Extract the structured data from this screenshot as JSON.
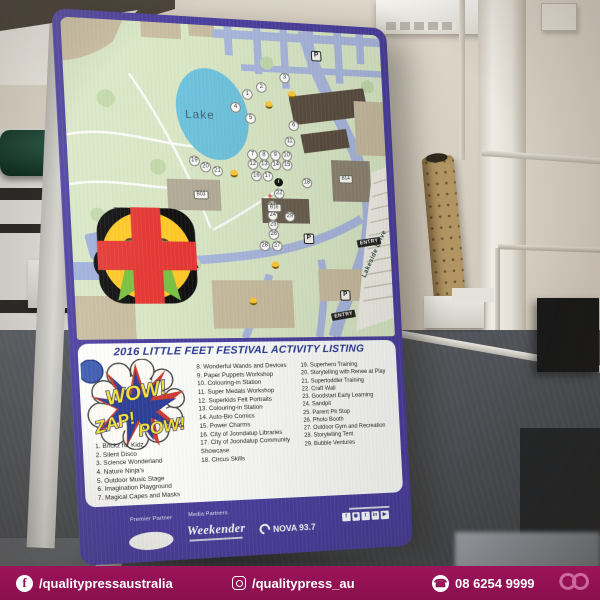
{
  "footer": {
    "facebook_handle": "/qualitypressaustralia",
    "instagram_handle": "/qualitypress_au",
    "phone": "08 6254 9999",
    "bar_color": "#931253"
  },
  "poster": {
    "accent_color": "#4b3f9d",
    "map": {
      "lake_label": "Lake",
      "road_label": "Lakeside Drive",
      "entry_label": "ENTRY",
      "parking_symbol": "P",
      "colors": {
        "ground": "#d9e7c6",
        "road": "#a9b7dd",
        "lake": "#6fc3dd",
        "building_tan": "#c9bda0",
        "building_dark": "#5a4e40"
      },
      "legend": [
        {
          "icon": "toilets-icon",
          "label": "Toilets"
        },
        {
          "icon": "acrod-toilets-icon",
          "label": "ACROD toilets"
        },
        {
          "icon": "event-info-icon",
          "label": "Event information"
        },
        {
          "icon": "parking-icon",
          "label": "Parking"
        },
        {
          "icon": "baby-changing-icon",
          "label": "Baby changing"
        },
        {
          "icon": "face-painter-icon",
          "label": "Face painter"
        },
        {
          "icon": "constable-care-icon",
          "label": "Constable Care (Lost Children)"
        },
        {
          "icon": "first-aid-icon",
          "label": "First Aid"
        }
      ],
      "overlays": [
        {
          "t": "num",
          "n": "1",
          "x": 183,
          "y": 70
        },
        {
          "t": "num",
          "n": "2",
          "x": 198,
          "y": 62
        },
        {
          "t": "num",
          "n": "3",
          "x": 223,
          "y": 51
        },
        {
          "t": "num",
          "n": "4",
          "x": 170,
          "y": 84
        },
        {
          "t": "num",
          "n": "5",
          "x": 185,
          "y": 95
        },
        {
          "t": "num",
          "n": "6",
          "x": 230,
          "y": 101
        },
        {
          "t": "num",
          "n": "7",
          "x": 185,
          "y": 133
        },
        {
          "t": "num",
          "n": "8",
          "x": 197,
          "y": 133
        },
        {
          "t": "num",
          "n": "9",
          "x": 209,
          "y": 133
        },
        {
          "t": "num",
          "n": "10",
          "x": 221,
          "y": 133
        },
        {
          "t": "num",
          "n": "11",
          "x": 225,
          "y": 118
        },
        {
          "t": "num",
          "n": "12",
          "x": 185,
          "y": 143
        },
        {
          "t": "num",
          "n": "13",
          "x": 197,
          "y": 143
        },
        {
          "t": "num",
          "n": "14",
          "x": 209,
          "y": 143
        },
        {
          "t": "num",
          "n": "15",
          "x": 221,
          "y": 143
        },
        {
          "t": "num",
          "n": "16",
          "x": 188,
          "y": 155
        },
        {
          "t": "num",
          "n": "17",
          "x": 200,
          "y": 155
        },
        {
          "t": "num",
          "n": "18",
          "x": 241,
          "y": 161
        },
        {
          "t": "num",
          "n": "19",
          "x": 125,
          "y": 141
        },
        {
          "t": "num",
          "n": "20",
          "x": 136,
          "y": 147
        },
        {
          "t": "num",
          "n": "21",
          "x": 148,
          "y": 151
        },
        {
          "t": "num",
          "n": "22",
          "x": 211,
          "y": 173
        },
        {
          "t": "num",
          "n": "23",
          "x": 203,
          "y": 186
        },
        {
          "t": "num",
          "n": "24",
          "x": 203,
          "y": 196
        },
        {
          "t": "num",
          "n": "25",
          "x": 203,
          "y": 206
        },
        {
          "t": "num",
          "n": "26",
          "x": 203,
          "y": 216
        },
        {
          "t": "num",
          "n": "27",
          "x": 206,
          "y": 228
        },
        {
          "t": "num",
          "n": "28",
          "x": 193,
          "y": 228
        },
        {
          "t": "num",
          "n": "29",
          "x": 221,
          "y": 197
        },
        {
          "t": "smiley",
          "x": 205,
          "y": 80
        },
        {
          "t": "smiley",
          "x": 230,
          "y": 68
        },
        {
          "t": "smiley",
          "x": 165,
          "y": 153
        },
        {
          "t": "smiley",
          "x": 203,
          "y": 248
        },
        {
          "t": "smiley",
          "x": 178,
          "y": 286
        },
        {
          "t": "toilets",
          "x": 160,
          "y": 167
        },
        {
          "t": "toilets",
          "x": 263,
          "y": 206
        },
        {
          "t": "toilets",
          "x": 175,
          "y": 266
        },
        {
          "t": "parking",
          "x": 258,
          "y": 26
        },
        {
          "t": "parking",
          "x": 240,
          "y": 220
        },
        {
          "t": "parking",
          "x": 276,
          "y": 280
        },
        {
          "t": "entry",
          "x": 305,
          "y": 223
        },
        {
          "t": "entry",
          "x": 273,
          "y": 301
        },
        {
          "t": "info",
          "x": 211,
          "y": 161
        },
        {
          "t": "firstaid",
          "x": 201,
          "y": 176
        },
        {
          "t": "bldg",
          "label": "B03",
          "x": 130,
          "y": 176
        },
        {
          "t": "bldg",
          "label": "B16",
          "x": 205,
          "y": 188
        },
        {
          "t": "bldg",
          "label": "B14",
          "x": 283,
          "y": 156
        }
      ]
    },
    "listing": {
      "title": "2016 LITTLE FEET FESTIVAL ACTIVITY LISTING",
      "burst_words": [
        "WOW!",
        "ZAP!",
        "POW!"
      ],
      "columns": [
        [
          "1. Brickz for Kidz",
          "2. Silent Disco",
          "3. Science Wonderland",
          "4. Nature Ninja's",
          "5. Outdoor Music Stage",
          "6. Imagination Playground",
          "7. Magical Capes and Masks"
        ],
        [
          "8. Wonderful Wands and Devices",
          "9. Paper Puppets Workshop",
          "10. Colouring-in Station",
          "11. Super Medals Workshop",
          "12. Superkids Felt Portraits",
          "13. Colouring-in Station",
          "14. Auto-Bio Comics",
          "15. Power Charms",
          "16. City of Joondalup Libraries",
          "17. City of Joondalup Community Showcase",
          "18. Circus Skills"
        ],
        [
          "19. Superhero Training",
          "20. Storytelling with Renee at Play",
          "21. Supertoddler Training",
          "22. Craft Wall",
          "23. Goodstart Early Learning",
          "24. Sandpit",
          "25. Parent Pit Stop",
          "26. Photo Booth",
          "27. Outdoor Gym and Recreation",
          "28. Storytelling Tent",
          "29. Bubble Ventures"
        ]
      ]
    },
    "partners": {
      "premier_label": "Premier Partner",
      "media_label": "Media Partners",
      "media_logos": [
        "Weekender",
        "NOVA 93.7"
      ],
      "social_icons": [
        "facebook-icon",
        "instagram-icon",
        "twitter-icon",
        "linkedin-icon",
        "youtube-icon"
      ]
    }
  }
}
